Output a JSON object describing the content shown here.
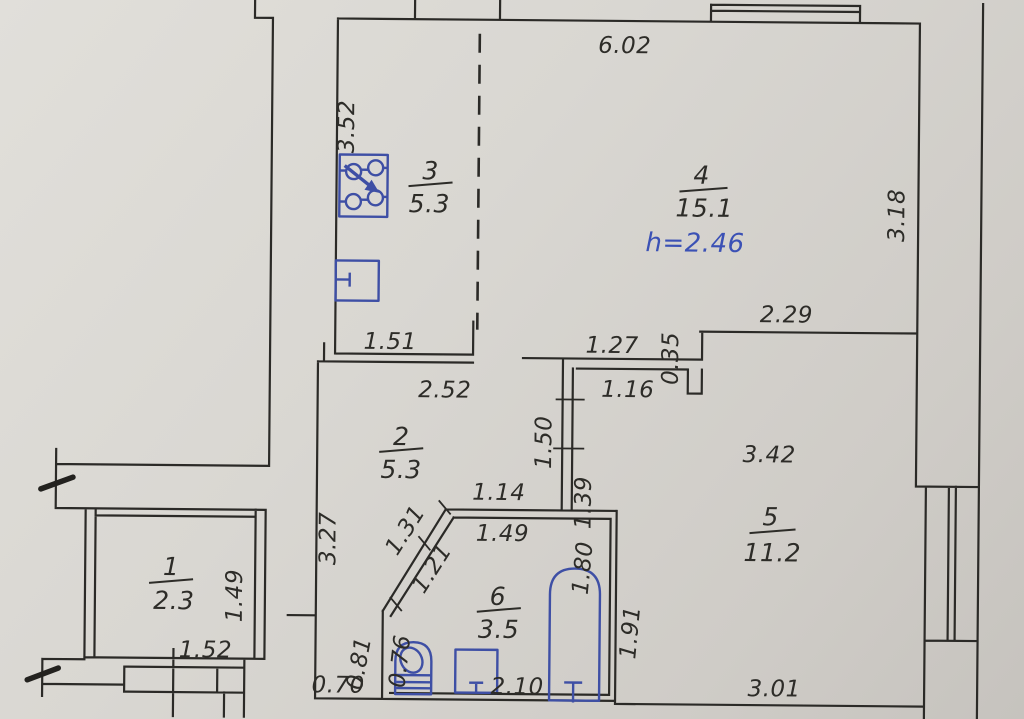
{
  "document": {
    "type": "apartment floor plan drawing",
    "units": "meters",
    "ceiling_height_note": "h=2.46"
  },
  "rooms": [
    {
      "number": "1",
      "area": "2.3"
    },
    {
      "number": "2",
      "area": "5.3"
    },
    {
      "number": "3",
      "area": "5.3"
    },
    {
      "number": "4",
      "area": "15.1"
    },
    {
      "number": "5",
      "area": "11.2"
    },
    {
      "number": "6",
      "area": "3.5"
    }
  ],
  "dimensions": {
    "top_width": "6.02",
    "kitchen_left_height": "3.52",
    "room4_right_height": "3.18",
    "room4_bottom_right": "2.29",
    "step_offset": "0.35",
    "hall_top": "1.27",
    "hall_inner": "1.16",
    "hall_wall_upper": "1.50",
    "hall_wall_lower": "1.39",
    "kitchen_bottom": "1.51",
    "room2_top": "2.52",
    "room5_width": "3.42",
    "room2_bottom": "1.14",
    "room2_left_height": "3.27",
    "diag_outer": "1.31",
    "diag_inner": "1.21",
    "bath_top": "1.49",
    "room1_right_height": "1.49",
    "bath_right_upper": "1.80",
    "room5_left_lower": "1.91",
    "vestibule_left": "0.81",
    "bath_left_inner": "0.76",
    "vestibule_bottom": "0.70",
    "bath_bottom": "2.10",
    "room5_bottom": "3.01",
    "porch_width": "1.52"
  },
  "fixtures": {
    "kitchen": [
      "electric-stove",
      "kitchen-sink"
    ],
    "bathroom": [
      "toilet",
      "wash-basin",
      "bathtub"
    ]
  },
  "colors": {
    "ink": "#2b2a27",
    "fixture_blue": "#3e4fa5",
    "note_blue": "#3b51b5",
    "paper": "#d9d7d2"
  }
}
